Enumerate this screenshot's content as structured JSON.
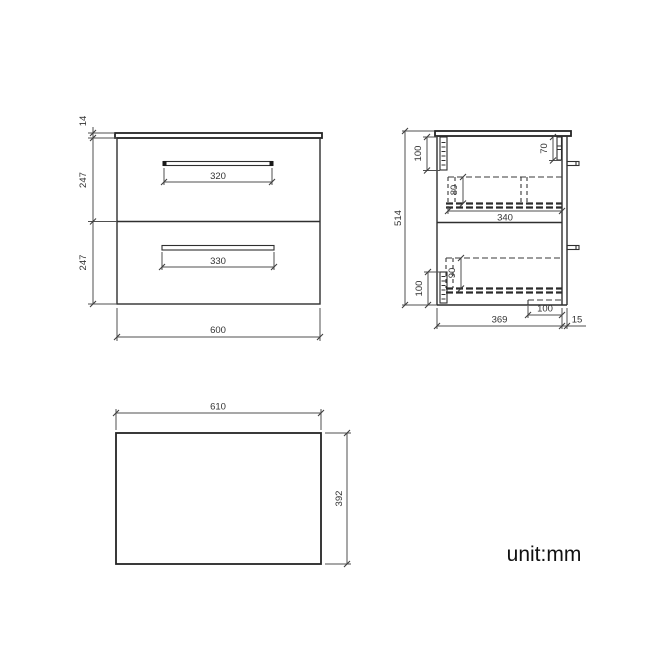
{
  "unit_note": "unit:mm",
  "colors": {
    "object_line": "#2f2f2f",
    "dimension_line": "#4f4f4f",
    "text": "#333333",
    "background": "#ffffff"
  },
  "front_view": {
    "dimensions": {
      "worktop_thickness": "14",
      "top_drawer_height": "247",
      "bottom_drawer_height": "247",
      "top_handle_width": "320",
      "bottom_handle_width": "330",
      "overall_width": "600"
    }
  },
  "side_view": {
    "dimensions": {
      "overall_height": "514",
      "top_rail_height": "100",
      "top_drawer_box_height": "80",
      "front_top_clearance": "70",
      "drawer_internal_depth": "340",
      "bottom_drawer_box_height": "90",
      "bottom_rail_height": "100",
      "base_recess_depth": "100",
      "cabinet_depth": "369",
      "drawer_front_thickness": "15"
    }
  },
  "plan_view": {
    "dimensions": {
      "worktop_width": "610",
      "worktop_depth": "392"
    }
  }
}
